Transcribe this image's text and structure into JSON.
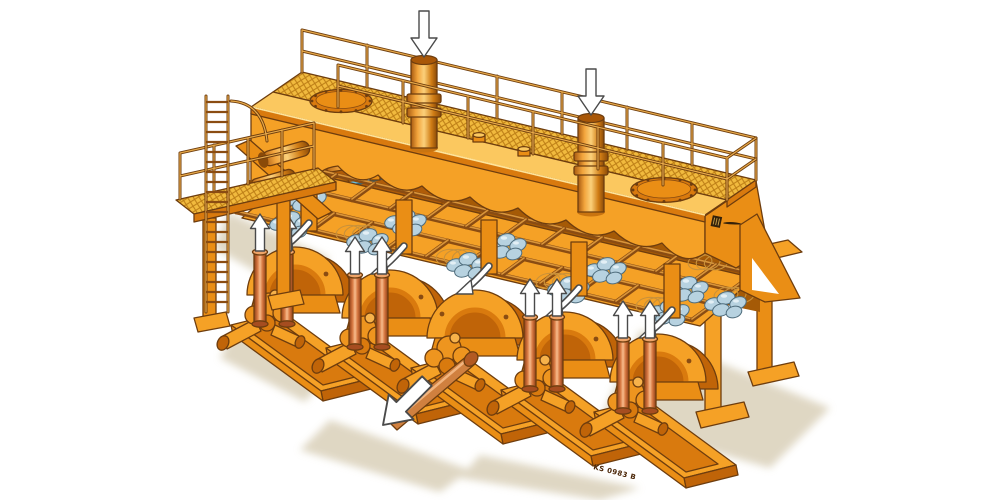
{
  "figure": {
    "description": "Isometric cutaway illustration of an orange industrial machine: top walkway with mesh grating and railings, access ladder, two inlet pipes with downward flow arrows, two bolted manhole covers, an inclined rack holding bundles of blue-grey rolls, and five drive units in front with red lift tubes and upward arrows; the centre unit has a long output spindle with an outward arrow.",
    "plate_number": "KS 0983 B"
  },
  "counts": {
    "drive_units": 5,
    "lift_tubes_with_arrows": 8,
    "top_inlet_pipes": 2,
    "down_arrows": 2,
    "bolted_manholes": 2,
    "roll_bundles": 11,
    "ladders": 1
  },
  "icons": {
    "down-arrow": "⬇",
    "up-arrow": "⬆",
    "flow-out-arrow": "⬋",
    "curved-flow-arrow": "↙",
    "manhole-bolted": "⊙",
    "mesh-grating": "▦",
    "ladder": "☰",
    "logo-emblem": "▮"
  },
  "colors": {
    "body_orange": "#f5a126",
    "body_mid": "#ea8e15",
    "body_dark": "#d97a0e",
    "body_deep": "#c06408",
    "body_light": "#fbc85f",
    "interior_shadow": "#a55a06",
    "outline_brown": "#6e3d0e",
    "mesh_yellow": "#f1ba3e",
    "mesh_line": "#bc7d15",
    "roll_blue": "#b7d2e0",
    "roll_outline": "#4e6c7c",
    "shaft_blue": "#67bede",
    "ground_shadow": "#dcd3bd",
    "background": "#ffffff",
    "arrow_white": "#ffffff",
    "arrow_outline": "#4a4a4a",
    "plate_text": "#4a2506"
  }
}
